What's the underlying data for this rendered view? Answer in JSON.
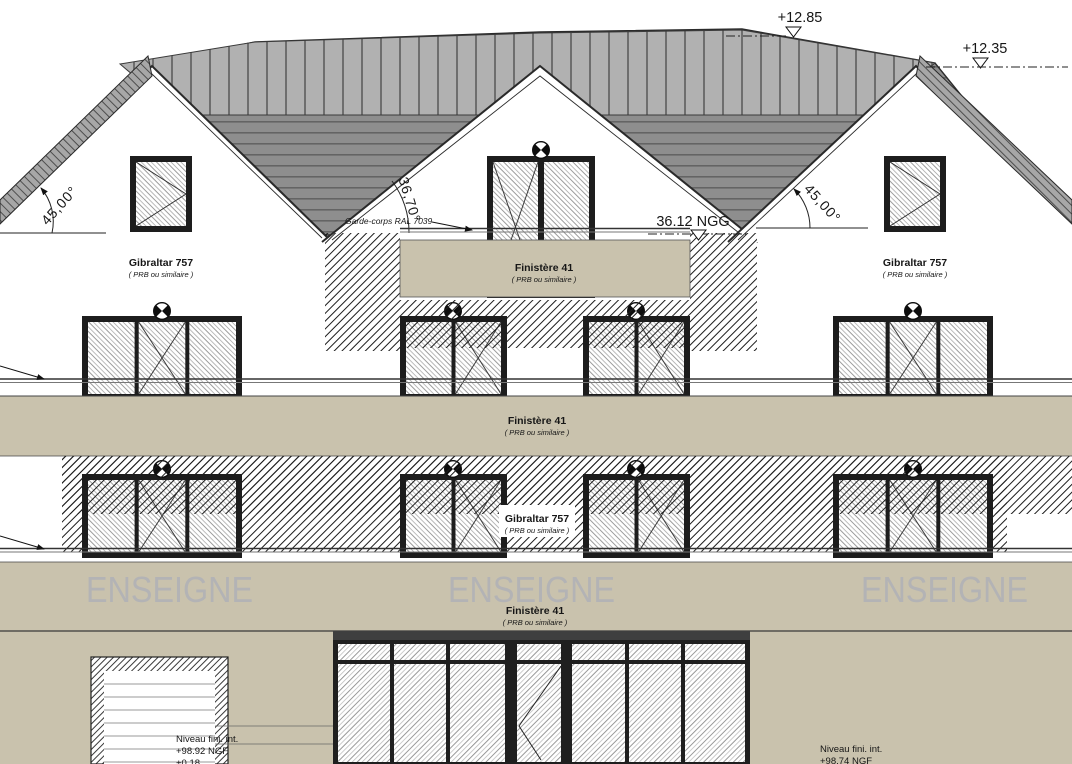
{
  "annotations": {
    "elev_ridge": "+12.85",
    "elev_eave_right": "+12.35",
    "angle_left": "45,00°",
    "angle_center": "36,70°",
    "angle_right": "45,00°",
    "garde_corps_note": "Garde-corps RAL 7039",
    "balcony_level": "36.12 NGG"
  },
  "materials": {
    "gibraltar": {
      "name": "Gibraltar 757",
      "alt": "( PRB ou similaire )"
    },
    "finistere": {
      "name": "Finistère 41",
      "alt": "( PRB ou similaire )"
    }
  },
  "signage": {
    "label": "ENSEIGNE"
  },
  "levels": {
    "ground_left": {
      "line1": "Niveau fini. int.",
      "line2": "+98.92 NGF",
      "line3": "+0.18"
    },
    "ground_right": {
      "line1": "Niveau fini. int.",
      "line2": "+98.74 NGF"
    }
  },
  "colors": {
    "facade_beige": "#c9c2ad",
    "roof_face": "#8e8e8e",
    "roof_ridge": "#b1b1b1",
    "signage_text": "#b3b3b5",
    "frame_dark": "#1d1d1d"
  }
}
